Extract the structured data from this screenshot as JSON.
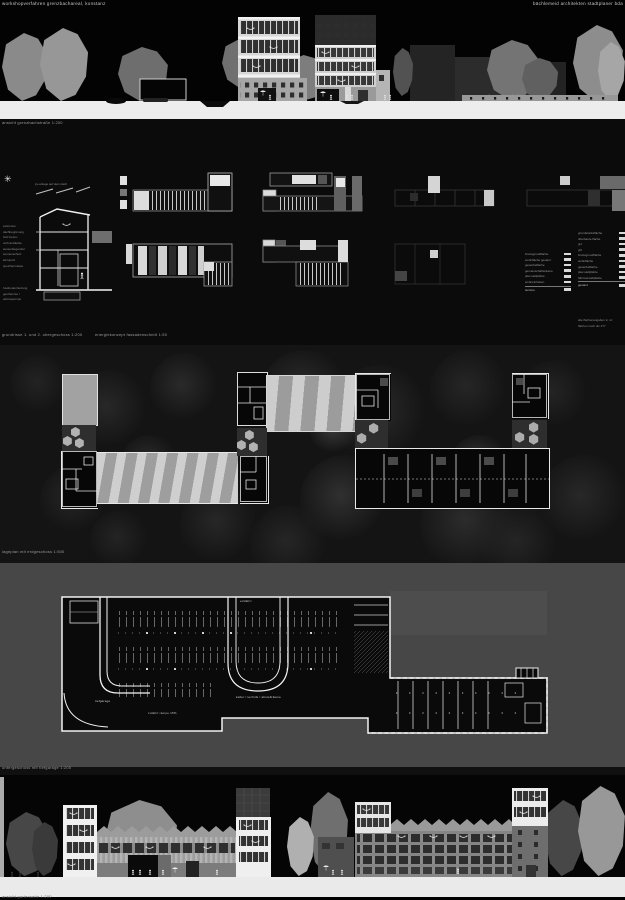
{
  "header": {
    "left": "workshopverfahren grenzbachareal, konstanz",
    "right": "bächlemeid architekten stadtplaner bda"
  },
  "captions": {
    "top_elevation": "ansicht grenzbachstraße 1:200",
    "plans": "grundrisse 1. und 2. obergeschoss 1:200",
    "energy": "energiekonzept fassadenschnitt 1:50",
    "site": "lageplan mit erdgeschoss 1:500",
    "garage": "untergeschoss mit tiefgarage 1:200",
    "bottom_elevation": "ansicht gartenseite 1:200"
  },
  "facade_detail": {
    "roof_note": "pv-anlage auf dem dach",
    "labels": [
      "extensive dachbegrünung",
      "holz-beton-verbunddecke",
      "aussenliegender sonnenschutz",
      "lehmputz speichermasse"
    ],
    "labels2": [
      "fussbodenheizung",
      "geothermie / wärmepumpe"
    ]
  },
  "garage_labels": {
    "entry": "einfahrt",
    "garage": "tiefgarage",
    "cellar": "keller / technik / abstellräume",
    "ramp": "zufahrt rampe 15%"
  },
  "legend_left": {
    "rows": [
      "bruttogrundfläche",
      "wohnfläche gesamt",
      "gewerbefläche",
      "gemeinschaftsräume",
      "pkw-stellplätze",
      "wohneinheiten"
    ],
    "total": "summe"
  },
  "legend_right": {
    "rows": [
      "grundstücksfläche",
      "überbaute fläche",
      "grz",
      "gfz",
      "bruttogrundfläche",
      "wohnfläche",
      "gewerbefläche",
      "pkw-stellplätze",
      "fahrrad-stellplätze"
    ],
    "total": "gesamt"
  },
  "plans_notes": [
    "alle flächenangaben in m²",
    "flächen nach din 277"
  ],
  "icons": {
    "sun": "✳"
  },
  "colors": {
    "board_bg": "#000000",
    "band_grey": "#474747",
    "ground_light": "#ededed",
    "roof_stripe_light": "#cfcfcf",
    "roof_stripe_dark": "#9e9e9e",
    "plan_line": "#e8e8e8"
  }
}
